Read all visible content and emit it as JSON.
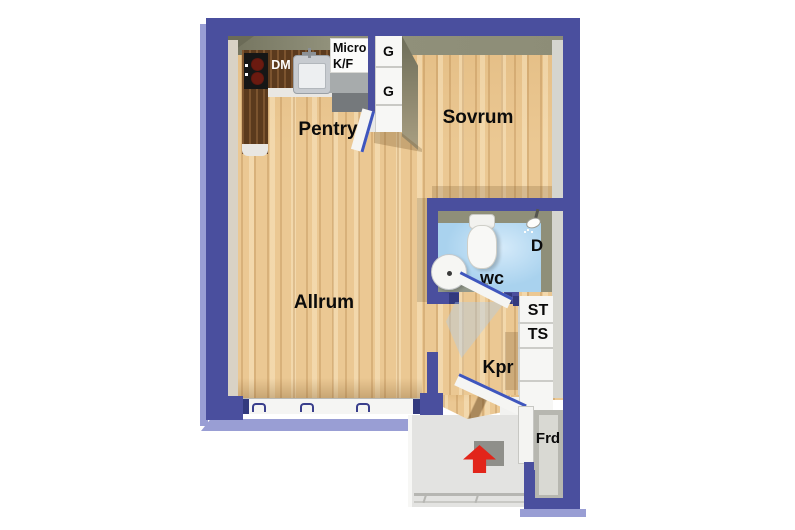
{
  "title": "Apartment floor plan",
  "rooms": {
    "pentry": "Pentry",
    "sovrum": "Sovrum",
    "allrum": "Allrum",
    "wc": "wc",
    "kpr": "Kpr"
  },
  "labels": {
    "dm": "DM",
    "micro_line1": "Micro",
    "micro_line2": "K/F",
    "wardrobe1": "G",
    "wardrobe2": "G",
    "shower": "D",
    "cleaning_cabinet": "ST",
    "drying_cabinet": "TS",
    "storage": "Frd"
  },
  "icons": {
    "entrance_arrow": "up-arrow",
    "shower_head": "shower-head"
  },
  "colors": {
    "wall_blue": "#4a4f9e",
    "wall_light_blue": "#999ed4",
    "wall_navy_accent": "#333a7e",
    "wood_floor": "#ebc893",
    "kitchen_counter_brown": "#5b3a1d",
    "wc_floor_blue": "#a9d2ee",
    "interior_wall_olive": "#8d8d77",
    "landing_gray": "#e3e3e1",
    "entry_arrow_red": "#e2251a",
    "door_edge_blue": "#3f56bd"
  }
}
